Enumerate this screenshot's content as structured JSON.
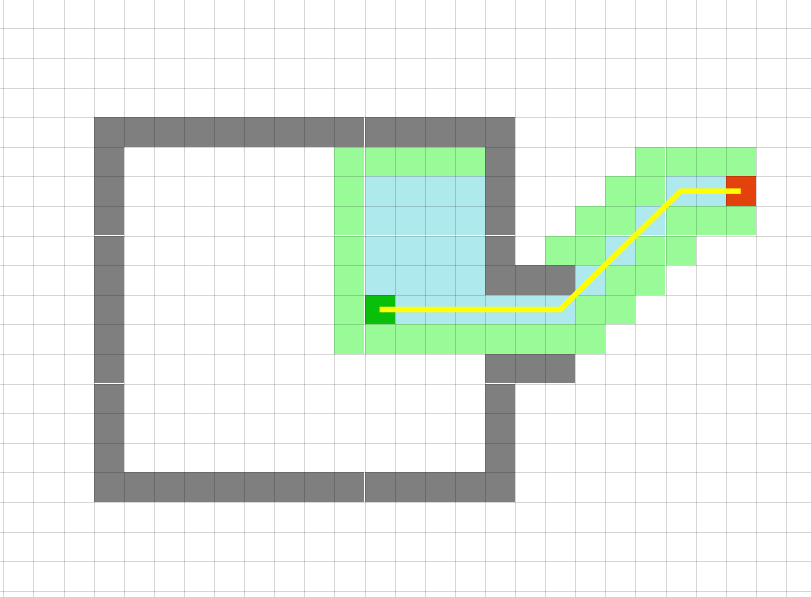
{
  "canvas": {
    "width": 811,
    "height": 597
  },
  "grid": {
    "cols": 27,
    "rows": 20,
    "cell_width": 30.1,
    "cell_height": 29.6,
    "offset_x": 3.3,
    "offset_y": -1.3
  },
  "colors": {
    "background": "#ffffff",
    "gridline": "rgba(0,0,0,0.16)",
    "wall": "#7f7f7f",
    "frontier": "#98fb98",
    "visited": "#aee9ee",
    "start": "#0abf0a",
    "goal": "#e4420c",
    "path": "#ffff00"
  },
  "cells": {
    "walls": [
      [
        3,
        4
      ],
      [
        4,
        4
      ],
      [
        5,
        4
      ],
      [
        6,
        4
      ],
      [
        7,
        4
      ],
      [
        8,
        4
      ],
      [
        9,
        4
      ],
      [
        10,
        4
      ],
      [
        11,
        4
      ],
      [
        12,
        4
      ],
      [
        13,
        4
      ],
      [
        14,
        4
      ],
      [
        15,
        4
      ],
      [
        16,
        4
      ],
      [
        3,
        5
      ],
      [
        3,
        6
      ],
      [
        3,
        7
      ],
      [
        3,
        8
      ],
      [
        3,
        9
      ],
      [
        3,
        10
      ],
      [
        3,
        11
      ],
      [
        3,
        12
      ],
      [
        3,
        13
      ],
      [
        3,
        14
      ],
      [
        3,
        15
      ],
      [
        3,
        16
      ],
      [
        4,
        16
      ],
      [
        5,
        16
      ],
      [
        6,
        16
      ],
      [
        7,
        16
      ],
      [
        8,
        16
      ],
      [
        9,
        16
      ],
      [
        10,
        16
      ],
      [
        11,
        16
      ],
      [
        12,
        16
      ],
      [
        13,
        16
      ],
      [
        14,
        16
      ],
      [
        15,
        16
      ],
      [
        16,
        16
      ],
      [
        16,
        5
      ],
      [
        16,
        6
      ],
      [
        16,
        7
      ],
      [
        16,
        8
      ],
      [
        16,
        9
      ],
      [
        16,
        12
      ],
      [
        16,
        13
      ],
      [
        16,
        14
      ],
      [
        16,
        15
      ],
      [
        17,
        9
      ],
      [
        18,
        9
      ],
      [
        17,
        12
      ],
      [
        18,
        12
      ]
    ],
    "frontier": [
      [
        11,
        5
      ],
      [
        12,
        5
      ],
      [
        13,
        5
      ],
      [
        14,
        5
      ],
      [
        15,
        5
      ],
      [
        21,
        5
      ],
      [
        22,
        5
      ],
      [
        23,
        5
      ],
      [
        24,
        5
      ],
      [
        11,
        6
      ],
      [
        20,
        6
      ],
      [
        21,
        6
      ],
      [
        11,
        7
      ],
      [
        19,
        7
      ],
      [
        20,
        7
      ],
      [
        22,
        7
      ],
      [
        23,
        7
      ],
      [
        24,
        7
      ],
      [
        11,
        8
      ],
      [
        18,
        8
      ],
      [
        19,
        8
      ],
      [
        21,
        8
      ],
      [
        22,
        8
      ],
      [
        11,
        9
      ],
      [
        20,
        9
      ],
      [
        21,
        9
      ],
      [
        11,
        10
      ],
      [
        19,
        10
      ],
      [
        20,
        10
      ],
      [
        11,
        11
      ],
      [
        12,
        11
      ],
      [
        13,
        11
      ],
      [
        14,
        11
      ],
      [
        15,
        11
      ],
      [
        16,
        11
      ],
      [
        17,
        11
      ],
      [
        18,
        11
      ],
      [
        19,
        11
      ]
    ],
    "visited": [
      [
        12,
        6
      ],
      [
        13,
        6
      ],
      [
        14,
        6
      ],
      [
        15,
        6
      ],
      [
        22,
        6
      ],
      [
        23,
        6
      ],
      [
        12,
        7
      ],
      [
        13,
        7
      ],
      [
        14,
        7
      ],
      [
        15,
        7
      ],
      [
        21,
        7
      ],
      [
        12,
        8
      ],
      [
        13,
        8
      ],
      [
        14,
        8
      ],
      [
        15,
        8
      ],
      [
        20,
        8
      ],
      [
        12,
        9
      ],
      [
        13,
        9
      ],
      [
        14,
        9
      ],
      [
        15,
        9
      ],
      [
        19,
        9
      ],
      [
        13,
        10
      ],
      [
        14,
        10
      ],
      [
        15,
        10
      ],
      [
        16,
        10
      ],
      [
        17,
        10
      ],
      [
        18,
        10
      ]
    ]
  },
  "start": {
    "col": 12,
    "row": 10
  },
  "goal": {
    "col": 24,
    "row": 6
  },
  "path": {
    "waypoint_cells": [
      [
        12,
        10
      ],
      [
        18,
        10
      ],
      [
        22,
        6
      ],
      [
        24,
        6
      ]
    ],
    "stroke_width": 5.5
  }
}
